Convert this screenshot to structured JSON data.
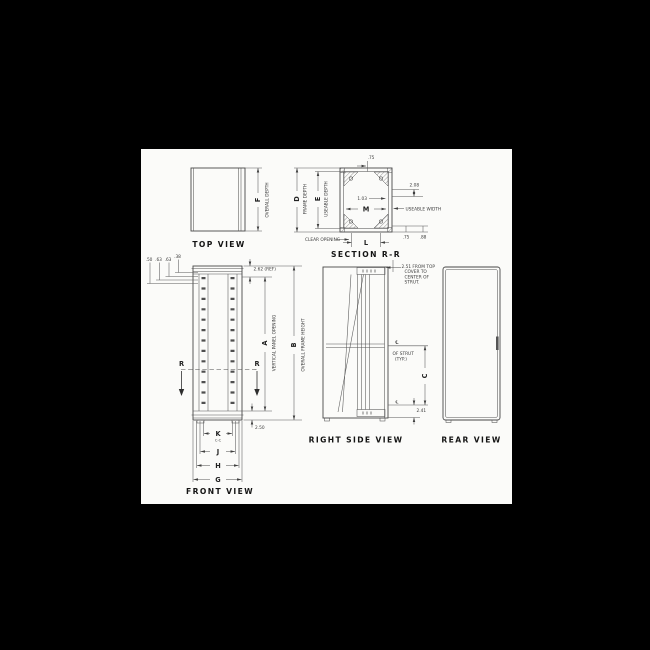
{
  "canvas": {
    "background": "#000000",
    "paper": "#fbfbf9",
    "ink": "#3b3b3b"
  },
  "top_view": {
    "title": "TOP VIEW",
    "dim_letter": "F",
    "dim_label": "OVERALL DEPTH"
  },
  "section_rr": {
    "title": "SECTION R-R",
    "dim_d_letter": "D",
    "dim_d_label": "FRAME DEPTH",
    "dim_e_letter": "E",
    "dim_e_label": "USEABLE DEPTH",
    "dim_top": ".75",
    "dim_right": "2.08",
    "dim_inner": "1.03",
    "dim_m_letter": "M",
    "useable_width_label": "USEABLE WIDTH",
    "clear_opening_label": "CLEAR OPENING",
    "dim_l_letter": "L",
    "dim_bottom_1": ".75",
    "dim_bottom_2": ".88"
  },
  "front_view": {
    "title": "FRONT VIEW",
    "offset_dims": [
      ".50",
      ".63",
      ".63",
      ".38"
    ],
    "ref_dim": "2.62 (REF)",
    "dim_a_letter": "A",
    "dim_a_label": "VERTICAL PANEL OPENING",
    "dim_b_letter": "B",
    "dim_b_label": "OVERALL FRAME HEIGHT",
    "section_cut_letter": "R",
    "dim_bottom_offset": "2.50",
    "dim_k_letter": "K",
    "dim_k_sub": "C-C",
    "dim_j_letter": "J",
    "dim_h_letter": "H",
    "dim_g_letter": "G"
  },
  "right_side_view": {
    "title": "RIGHT SIDE VIEW",
    "strut_note_lines": [
      "2.51 FROM TOP",
      "COVER TO",
      "CENTER OF",
      "STRUT."
    ],
    "centerline_symbol": "℄",
    "strut_cl_lines": [
      "OF STRUT",
      "(TYP.)"
    ],
    "dim_c_letter": "C",
    "dim_bottom": "2.41"
  },
  "rear_view": {
    "title": "REAR VIEW"
  }
}
